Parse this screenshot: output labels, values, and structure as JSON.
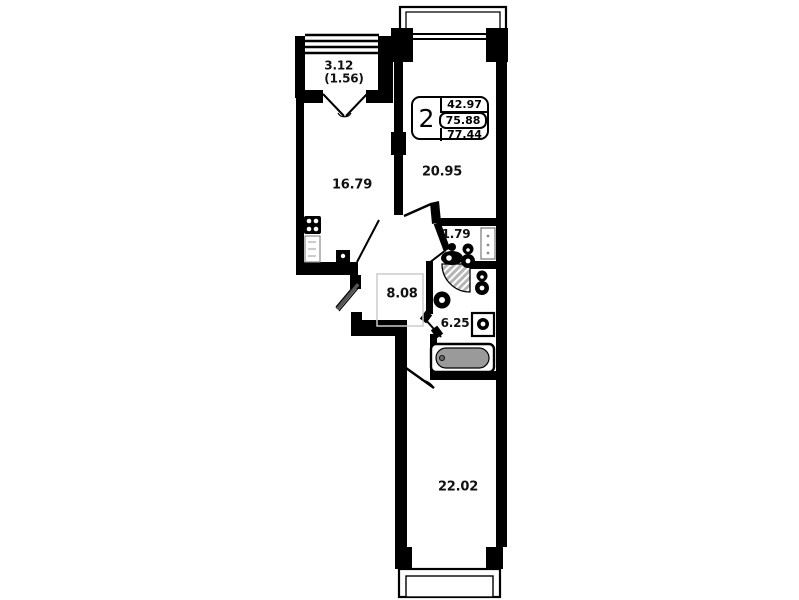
{
  "plan": {
    "stamp": {
      "room_count": "2",
      "living_area": "42.97",
      "apartment_area": "75.88",
      "total_area": "77.44"
    },
    "rooms": {
      "balcony": {
        "area": "3.12",
        "area_reduced": "(1.56)"
      },
      "kitchen": {
        "area": "16.79"
      },
      "living_room": {
        "area": "20.95"
      },
      "wc": {
        "area": "1.79"
      },
      "hallway": {
        "area": "8.08"
      },
      "bathroom": {
        "area": "6.25"
      },
      "bedroom": {
        "area": "22.02"
      }
    },
    "colors": {
      "wall": "#000000",
      "bathtub_fill": "#9a9a9a",
      "door_arc_fill": "#b5b5b5",
      "closet_outline": "#cccccc",
      "text": "#111111"
    }
  }
}
